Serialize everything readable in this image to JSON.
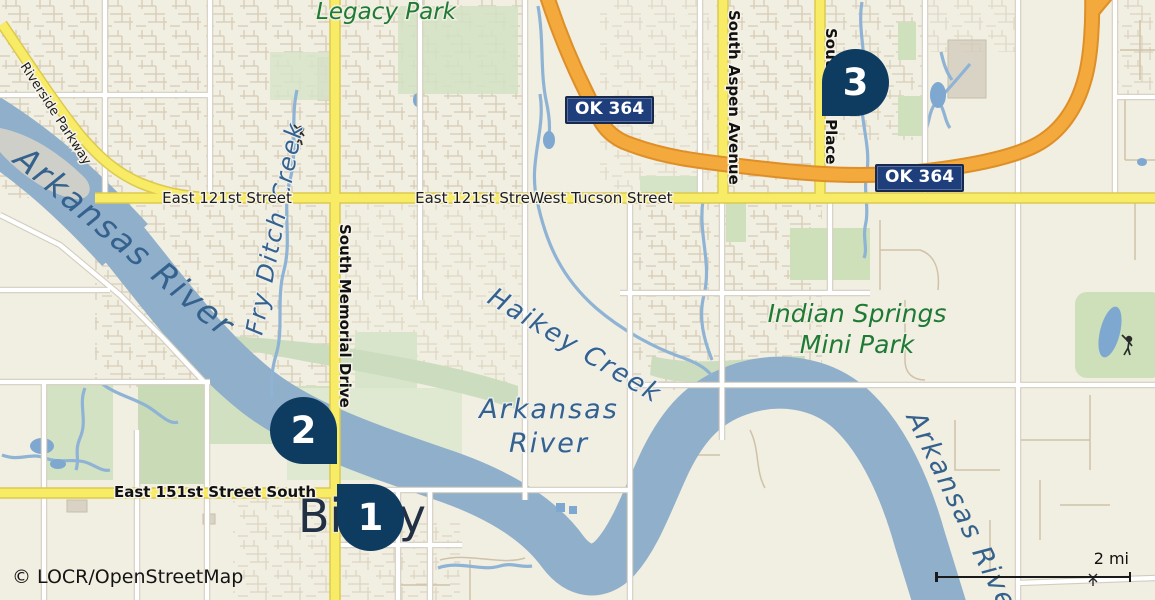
{
  "map": {
    "attribution": "© LOCR/OpenStreetMap",
    "scale": {
      "label": "2 mi"
    },
    "city_label": "Bixby",
    "markers": [
      {
        "number": "1"
      },
      {
        "number": "2"
      },
      {
        "number": "3"
      }
    ],
    "route_badges": [
      {
        "label": "OK 364"
      },
      {
        "label": "OK 364"
      }
    ],
    "streets": {
      "riverside_parkway": "Riverside Parkway",
      "east_121st_west": "East 121st Street",
      "east_121st_center": "East 121st Street",
      "west_tucson": "West Tucson Street",
      "memorial": "South Memorial Drive",
      "aspen": "South Aspen Avenue",
      "elm": "South Elm Place",
      "east_151st": "East 151st Street South"
    },
    "water": {
      "river_nw": "Arkansas River",
      "river_center_line1": "Arkansas",
      "river_center_line2": "River",
      "river_se": "Arkansas River",
      "fry_ditch": "Fry Ditch Creek",
      "haikey": "Haikey Creek"
    },
    "parks": {
      "legacy": "Legacy Park",
      "indian_springs_line1": "Indian Springs",
      "indian_springs_line2": "Mini Park"
    },
    "colors": {
      "background": "#f1eee2",
      "water": "#8fafca",
      "road_yellow": "#f8eb66",
      "road_orange": "#f3a93c",
      "park_green": "#cde0ba",
      "marker": "#0e3c61",
      "badge_bg": "#1f3e7c",
      "badge_text": "#ffffff",
      "water_label": "#35618d",
      "park_label": "#1f7a35"
    }
  }
}
